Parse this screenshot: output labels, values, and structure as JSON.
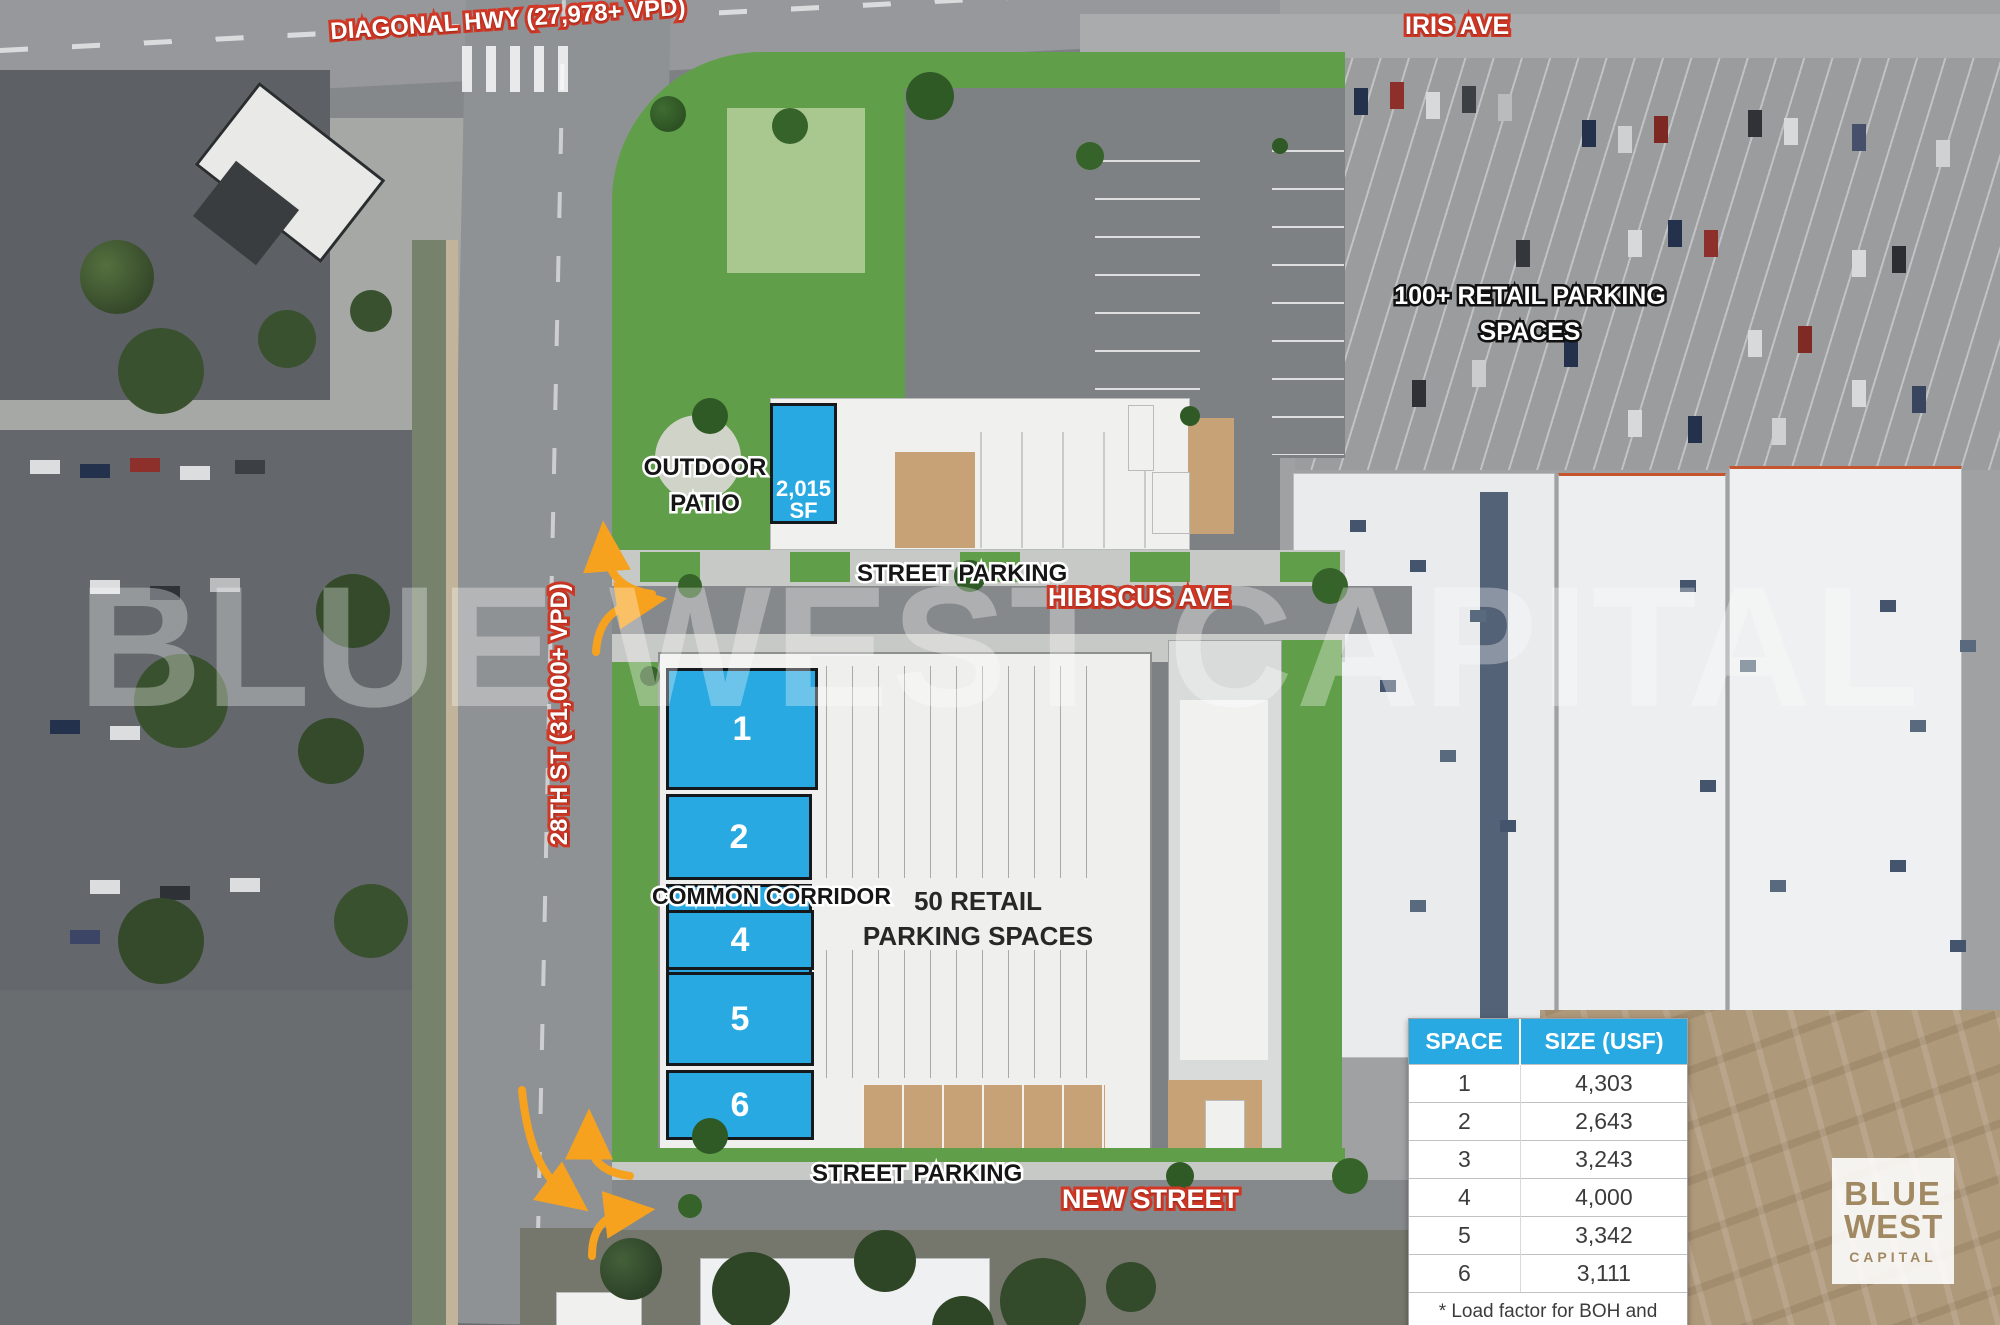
{
  "road_labels": {
    "diagonal_hwy": "DIAGONAL HWY (27,978+ VPD)",
    "iris_ave": "IRIS AVE",
    "hibiscus_ave": "HIBISCUS AVE",
    "new_street": "NEW STREET",
    "twenty_eighth_st": "28TH ST (31,000+ VPD)"
  },
  "site_labels": {
    "outdoor_patio": "OUTDOOR PATIO",
    "street_parking_top": "STREET PARKING",
    "street_parking_bottom": "STREET PARKING",
    "common_corridor": "COMMON CORRIDOR",
    "retail_parking_50": "50 RETAIL PARKING SPACES",
    "retail_parking_100": "100+ RETAIL PARKING SPACES",
    "unit_size": "2,015 SF"
  },
  "spaces": [
    {
      "num": "1",
      "size": "4,303"
    },
    {
      "num": "2",
      "size": "2,643"
    },
    {
      "num": "3",
      "size": "3,243"
    },
    {
      "num": "4",
      "size": "4,000"
    },
    {
      "num": "5",
      "size": "3,342"
    },
    {
      "num": "6",
      "size": "3,111"
    }
  ],
  "table": {
    "col_space": "SPACE",
    "col_size": "SIZE (USF)",
    "footnote": "* Load factor for BOH and breezeway common area"
  },
  "watermark": "BLUE WEST CAPITAL",
  "logo": {
    "top": "BLUE",
    "mid": "WEST",
    "bottom": "CAPITAL"
  },
  "colors": {
    "accent_blue": "#29a9e1",
    "label_red": "#d13826",
    "arrow_orange": "#f6a21e",
    "render_green": "#609e49",
    "tan_building": "#c8a277"
  }
}
